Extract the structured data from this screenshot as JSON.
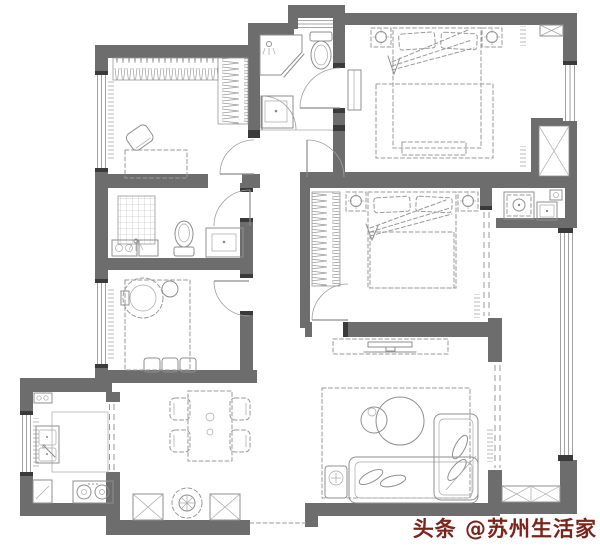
{
  "image": {
    "type": "residential-floor-plan",
    "width": 600,
    "height": 547
  },
  "colors": {
    "background": "#ffffff",
    "wall": "#6d6d6d",
    "wall_dark": "#3a3a3a",
    "furniture_line": "#8f8f8f",
    "dashed_line": "#9a9a9a",
    "watermark": "#7b241c"
  },
  "watermark": {
    "text": "头条 @苏州生活家"
  },
  "rooms": [
    {
      "name": "walk-in-closet",
      "fixtures": [
        "wardrobe-hangers-top",
        "wardrobe-hangers-side",
        "desk",
        "chair",
        "window"
      ]
    },
    {
      "name": "bathroom-top",
      "fixtures": [
        "corner-shower",
        "wall-hung-toilet",
        "vanity-sink",
        "window"
      ]
    },
    {
      "name": "master-bedroom",
      "fixtures": [
        "double-bed",
        "pillows",
        "nightstand-left",
        "nightstand-right",
        "lamps",
        "rug",
        "foot-bench",
        "dresser",
        "vent-box"
      ]
    },
    {
      "name": "elevator-shaft",
      "fixtures": [
        "x-cross"
      ]
    },
    {
      "name": "bedroom-2",
      "fixtures": [
        "double-bed",
        "pillows",
        "nightstand-left",
        "nightstand-right",
        "wardrobe-hangers",
        "sliding-window"
      ]
    },
    {
      "name": "bathroom-right",
      "fixtures": [
        "shower-cabin",
        "vanity-sink",
        "water-heater-box"
      ]
    },
    {
      "name": "bathroom-left",
      "fixtures": [
        "shower-grid",
        "washing-machine",
        "cabinet",
        "toilet",
        "vanity-sink"
      ]
    },
    {
      "name": "lounge-room",
      "fixtures": [
        "round-lounge-chair",
        "side-table",
        "floor-cushions",
        "rug",
        "window"
      ]
    },
    {
      "name": "kitchen",
      "fixtures": [
        "double-sink",
        "gas-stove",
        "counter",
        "corner-cabinet",
        "small-appliance",
        "sliding-door",
        "window"
      ]
    },
    {
      "name": "dining-area",
      "fixtures": [
        "dining-table",
        "chair",
        "chair",
        "chair",
        "chair"
      ]
    },
    {
      "name": "entry",
      "fixtures": [
        "shoe-cabinet-x",
        "plant",
        "shoe-cabinet-x",
        "threshold"
      ]
    },
    {
      "name": "living-room",
      "fixtures": [
        "tv-cabinet",
        "tv",
        "rug",
        "nesting-round-tables",
        "sofa",
        "chaise",
        "pillows",
        "side-table-plant",
        "sliding-door"
      ]
    },
    {
      "name": "balcony",
      "fixtures": [
        "window-band",
        "storage-cabinet-x"
      ]
    }
  ]
}
